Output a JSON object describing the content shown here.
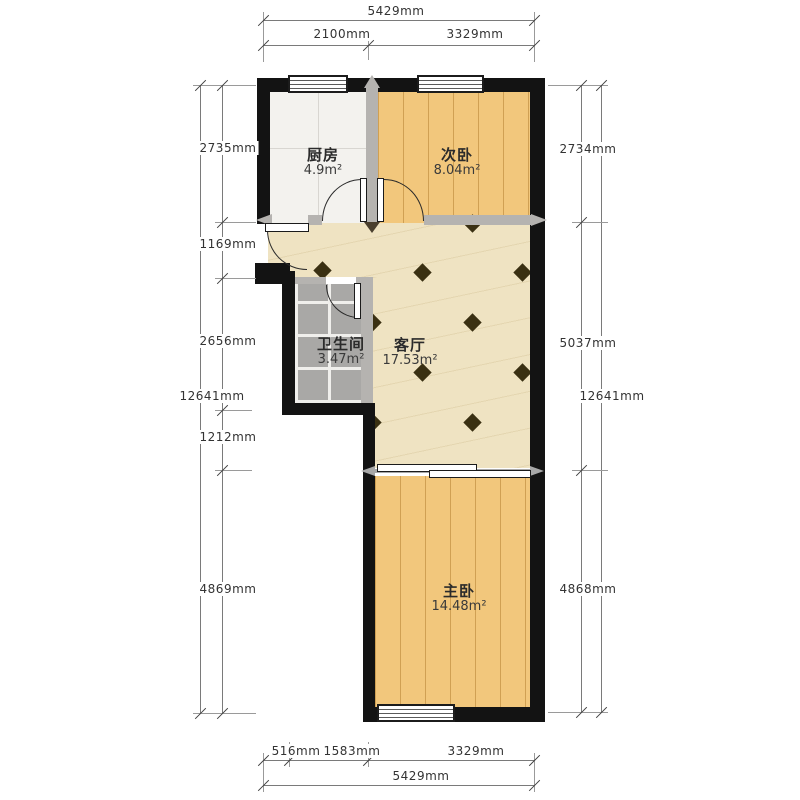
{
  "title": "户型图",
  "rooms": {
    "kitchen": {
      "name": "厨房",
      "area": "4.9m²"
    },
    "second_bedroom": {
      "name": "次卧",
      "area": "8.04m²"
    },
    "bathroom": {
      "name": "卫生间",
      "area": "3.47m²"
    },
    "living_room": {
      "name": "客厅",
      "area": "17.53m²"
    },
    "master_bedroom": {
      "name": "主卧",
      "area": "14.48m²"
    }
  },
  "dimensions": {
    "top": {
      "total": "5429mm",
      "segments": [
        "2100mm",
        "3329mm"
      ]
    },
    "bottom": {
      "total": "5429mm",
      "segments": [
        "516mm",
        "1583mm",
        "3329mm"
      ]
    },
    "left": {
      "total": "12641mm",
      "segments": [
        "2735mm",
        "1169mm",
        "2656mm",
        "1212mm",
        "4869mm"
      ]
    },
    "right": {
      "total": "12641mm",
      "segments": [
        "2734mm",
        "5037mm",
        "4868mm"
      ]
    }
  },
  "colors": {
    "wall": "#131313",
    "iwall": "#b5b3b0",
    "wood": "#f2c77c",
    "living": "#efe3c2",
    "kitchen": "#f3f2ee",
    "bathtile": "#a9a8a6",
    "diamond": "#3a3012",
    "dimtext": "#333333"
  }
}
